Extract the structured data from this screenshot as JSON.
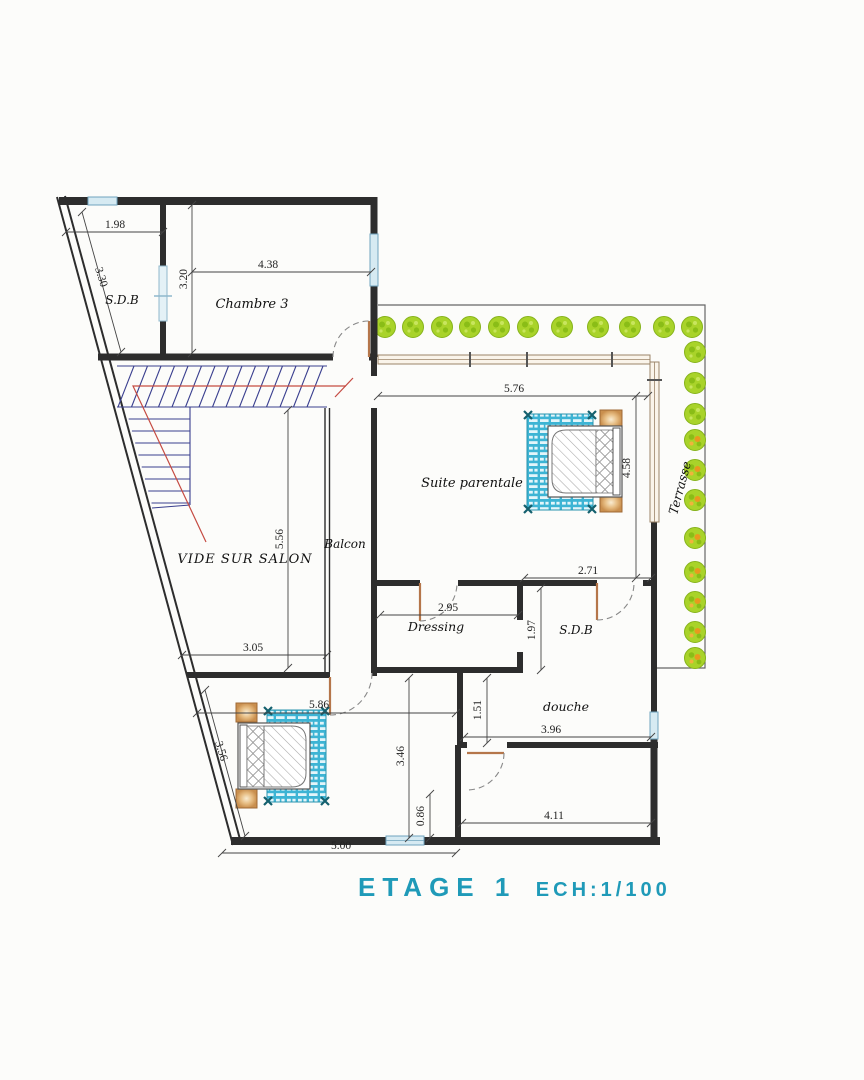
{
  "plan": {
    "title": "ETAGE 1",
    "scale_label": "ECH:1/100"
  },
  "colors": {
    "wall": "#2d2d2d",
    "window": "#d6eaf2",
    "window_frame": "#6fa3bd",
    "bay_frame": "#9b8468",
    "door_leaf": "#b5764a",
    "arc": "#888888",
    "rug_teal": "#3db4d4",
    "tree_green": "#a9d32a",
    "tree_dark": "#86b31a",
    "tree_orange": "#e8991e",
    "stair_navy": "#3a3f8f",
    "stair_red": "#c54b42",
    "title_teal": "#1f9ab8",
    "dim": "#333333"
  },
  "rooms": [
    {
      "id": "sdb-top",
      "label": "S.D.B",
      "x": 122,
      "y": 304,
      "size": 12
    },
    {
      "id": "chambre-3",
      "label": "Chambre 3",
      "x": 252,
      "y": 308,
      "size": 13
    },
    {
      "id": "vide-sur-salon",
      "label": "VIDE SUR SALON",
      "x": 245,
      "y": 563,
      "size": 13,
      "ls": 1
    },
    {
      "id": "balcon",
      "label": "Balcon",
      "x": 345,
      "y": 548,
      "size": 12
    },
    {
      "id": "suite-parentale",
      "label": "Suite parentale",
      "x": 472,
      "y": 487,
      "size": 13
    },
    {
      "id": "dressing",
      "label": "Dressing",
      "x": 436,
      "y": 631,
      "size": 12.5
    },
    {
      "id": "sdb-master",
      "label": "S.D.B",
      "x": 576,
      "y": 634,
      "size": 12
    },
    {
      "id": "douche",
      "label": "douche",
      "x": 566,
      "y": 711,
      "size": 12.5
    },
    {
      "id": "terrasse",
      "label": "Terrasse",
      "x": 684,
      "y": 489,
      "size": 12.5,
      "rot": -75
    }
  ],
  "dimensions_m": [
    {
      "id": "d-198",
      "v": "1.98",
      "x1": 66,
      "y1": 232,
      "x2": 163,
      "y2": 232,
      "lx": 115,
      "ly": 228
    },
    {
      "id": "d-330",
      "v": "3.30",
      "x1": 82,
      "y1": 212,
      "x2": 121,
      "y2": 352,
      "lx": 98,
      "ly": 278,
      "rot": 73
    },
    {
      "id": "d-320",
      "v": "3.20",
      "x1": 192,
      "y1": 205,
      "x2": 192,
      "y2": 353,
      "lx": 187,
      "ly": 279,
      "rot": -90
    },
    {
      "id": "d-438",
      "v": "4.38",
      "x1": 192,
      "y1": 272,
      "x2": 371,
      "y2": 272,
      "lx": 268,
      "ly": 268
    },
    {
      "id": "d-576",
      "v": "5.76",
      "x1": 378,
      "y1": 396,
      "x2": 648,
      "y2": 396,
      "lx": 514,
      "ly": 392
    },
    {
      "id": "d-458",
      "v": "4.58",
      "x1": 636,
      "y1": 396,
      "x2": 636,
      "y2": 578,
      "lx": 630,
      "ly": 468,
      "rot": -90
    },
    {
      "id": "d-271",
      "v": "2.71",
      "x1": 524,
      "y1": 578,
      "x2": 651,
      "y2": 578,
      "lx": 588,
      "ly": 574
    },
    {
      "id": "d-295",
      "v": "2.95",
      "x1": 380,
      "y1": 615,
      "x2": 518,
      "y2": 615,
      "lx": 448,
      "ly": 611
    },
    {
      "id": "d-197",
      "v": "1.97",
      "x1": 541,
      "y1": 588,
      "x2": 541,
      "y2": 670,
      "lx": 535,
      "ly": 630,
      "rot": -90
    },
    {
      "id": "d-151",
      "v": "1.51",
      "x1": 487,
      "y1": 678,
      "x2": 487,
      "y2": 743,
      "lx": 481,
      "ly": 710,
      "rot": -90
    },
    {
      "id": "d-396",
      "v": "3.96",
      "x1": 464,
      "y1": 737,
      "x2": 651,
      "y2": 737,
      "lx": 551,
      "ly": 733
    },
    {
      "id": "d-346",
      "v": "3.46",
      "x1": 409,
      "y1": 678,
      "x2": 409,
      "y2": 838,
      "lx": 404,
      "ly": 756,
      "rot": -90
    },
    {
      "id": "d-586",
      "v": "5.86",
      "x1": 197,
      "y1": 713,
      "x2": 456,
      "y2": 713,
      "lx": 319,
      "ly": 708
    },
    {
      "id": "d-356",
      "v": "3.56",
      "x1": 205,
      "y1": 690,
      "x2": 245,
      "y2": 836,
      "lx": 218,
      "ly": 752,
      "rot": 73
    },
    {
      "id": "d-086",
      "v": "0.86",
      "x1": 430,
      "y1": 794,
      "x2": 430,
      "y2": 838,
      "lx": 424,
      "ly": 816,
      "rot": -90
    },
    {
      "id": "d-411",
      "v": "4.11",
      "x1": 462,
      "y1": 823,
      "x2": 651,
      "y2": 823,
      "lx": 554,
      "ly": 819
    },
    {
      "id": "d-500",
      "v": "5.00",
      "x1": 222,
      "y1": 853,
      "x2": 456,
      "y2": 853,
      "lx": 341,
      "ly": 849
    },
    {
      "id": "d-305",
      "v": "3.05",
      "x1": 182,
      "y1": 655,
      "x2": 327,
      "y2": 655,
      "lx": 253,
      "ly": 651
    },
    {
      "id": "d-556",
      "v": "5.56",
      "x1": 288,
      "y1": 410,
      "x2": 288,
      "y2": 668,
      "lx": 283,
      "ly": 539,
      "rot": -90
    }
  ],
  "trees": [
    {
      "x": 385,
      "y": 327
    },
    {
      "x": 413,
      "y": 327
    },
    {
      "x": 442,
      "y": 327
    },
    {
      "x": 470,
      "y": 327
    },
    {
      "x": 499,
      "y": 327
    },
    {
      "x": 528,
      "y": 327
    },
    {
      "x": 562,
      "y": 327
    },
    {
      "x": 598,
      "y": 327
    },
    {
      "x": 630,
      "y": 327
    },
    {
      "x": 664,
      "y": 327
    },
    {
      "x": 692,
      "y": 327
    },
    {
      "x": 695,
      "y": 352
    },
    {
      "x": 695,
      "y": 383
    },
    {
      "x": 695,
      "y": 414
    },
    {
      "x": 695,
      "y": 440,
      "o": 1
    },
    {
      "x": 695,
      "y": 470,
      "o": 1
    },
    {
      "x": 695,
      "y": 500,
      "o": 1
    },
    {
      "x": 695,
      "y": 538,
      "o": 1
    },
    {
      "x": 695,
      "y": 572,
      "o": 1
    },
    {
      "x": 695,
      "y": 602,
      "o": 1
    },
    {
      "x": 695,
      "y": 632,
      "o": 1
    },
    {
      "x": 695,
      "y": 658,
      "o": 1
    }
  ]
}
